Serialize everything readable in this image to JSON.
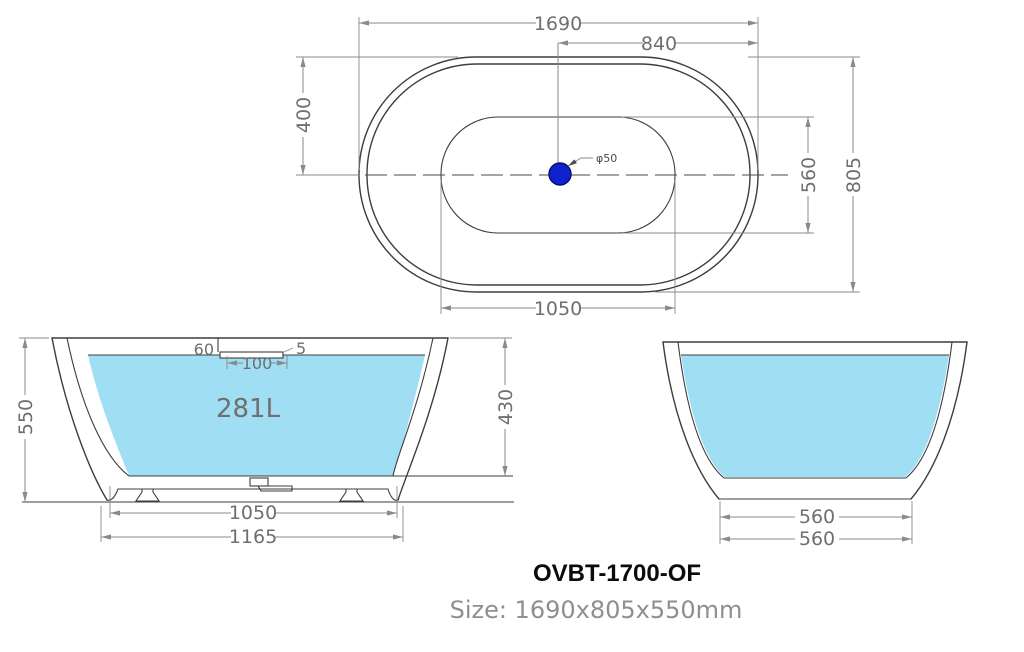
{
  "colors": {
    "water": "#A0DEF4",
    "drain": "#1320D0",
    "drain_outline": "#001266",
    "line": "#3D3D3D",
    "dim": "#8A8A8A",
    "dim_text": "#6F6F6F"
  },
  "top_view": {
    "dim_overall_length": "1690",
    "dim_center_to_end": "840",
    "dim_edge_to_center": "400",
    "dim_floor_width": "560",
    "dim_overall_width": "805",
    "dim_floor_length": "1050",
    "drain_label": "φ50"
  },
  "front_view": {
    "dim_height": "550",
    "dim_overflow_offset": "60",
    "dim_overflow_thickness": "5",
    "dim_overflow_width": "100",
    "capacity_label": "281L",
    "dim_inner_depth": "430",
    "dim_base_length": "1050",
    "dim_bottom_length": "1165"
  },
  "side_view": {
    "dim_base_width_inner": "560",
    "dim_base_width_outer": "560"
  },
  "footer": {
    "model": "OVBT-1700-OF",
    "size": "Size: 1690x805x550mm"
  }
}
